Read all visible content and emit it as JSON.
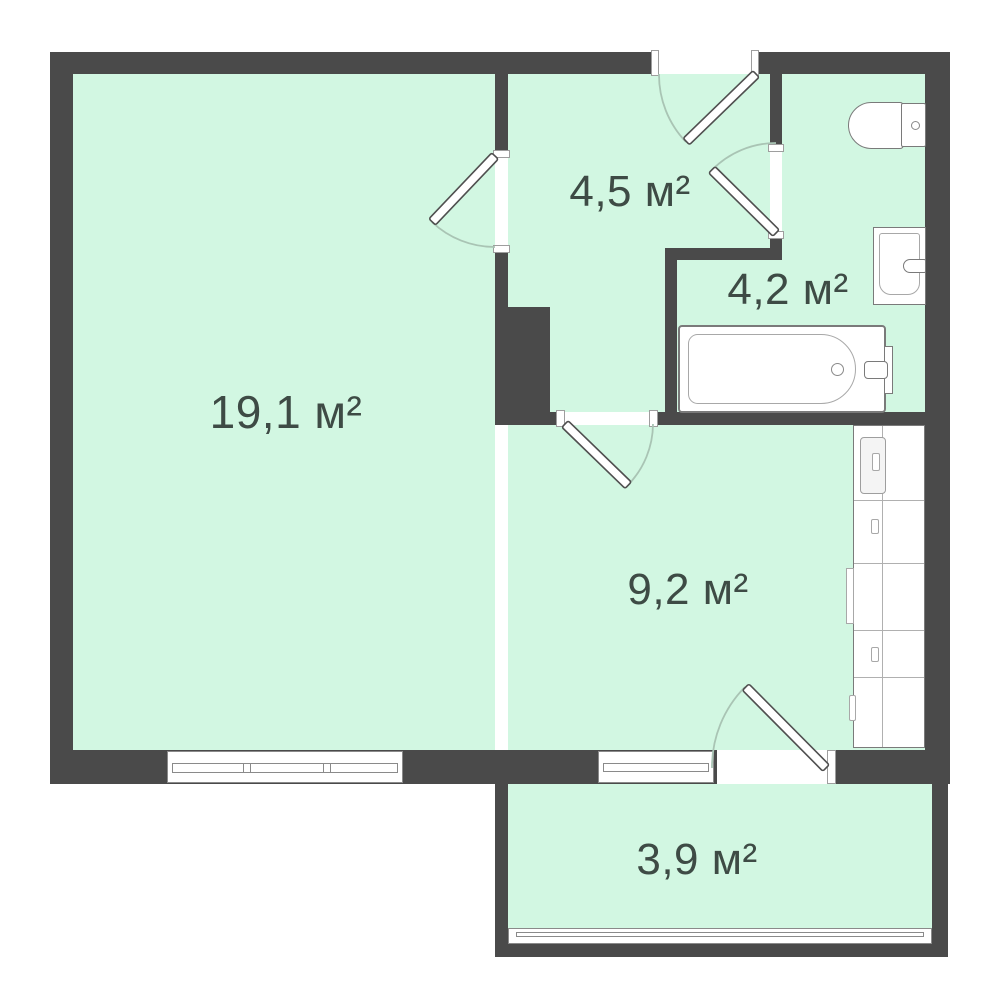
{
  "plan": {
    "type": "apartment-floor-plan",
    "rooms": [
      {
        "id": "living-room",
        "area_label": "19,1 м²"
      },
      {
        "id": "hallway",
        "area_label": "4,5 м²"
      },
      {
        "id": "bathroom",
        "area_label": "4,2 м²"
      },
      {
        "id": "kitchen",
        "area_label": "9,2 м²"
      },
      {
        "id": "balcony",
        "area_label": "3,9 м²"
      }
    ],
    "fixtures": [
      "toilet",
      "sink",
      "bathtub",
      "bathtub-faucet",
      "kitchen-counter",
      "fridge",
      "stove"
    ],
    "openings": [
      "entrance-door",
      "living-room-door",
      "bathroom-door",
      "kitchen-door",
      "balcony-door",
      "living-room-window",
      "kitchen-window",
      "balcony-glazing"
    ],
    "colors": {
      "background": "#ffffff",
      "wall": "#4a4a4a",
      "floor": "#d2f7e2",
      "fixture_outline": "#7a7a7a",
      "arc": "#a9c4b4",
      "label_text": "#3e4b45"
    }
  }
}
